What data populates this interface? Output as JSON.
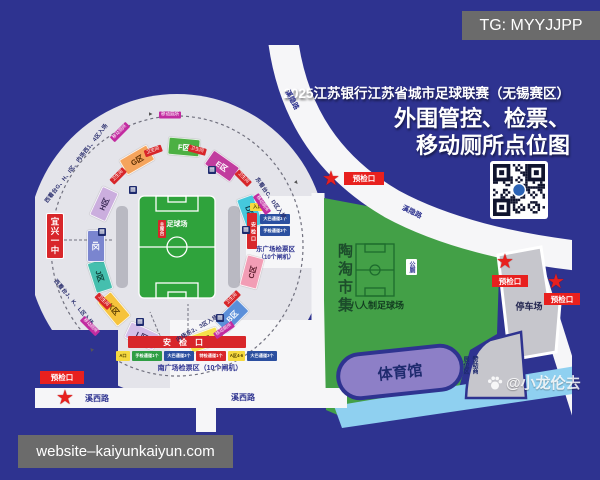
{
  "overlay": {
    "tg": "TG: MYYJJPP",
    "website": "website–kaiyunkaiyun.com"
  },
  "title": {
    "line1": "2025江苏银行江苏省城市足球联赛（无锡赛区）",
    "line2": "外围管控、检票、",
    "line3": "移动厕所点位图"
  },
  "stadium": {
    "pitch_label": "足球场",
    "rostrum": "主席台",
    "school": "宜兴一中",
    "sections": [
      {
        "id": "A",
        "label": "A区",
        "bg": "#f5e04a",
        "fg": "#4a3a00"
      },
      {
        "id": "B",
        "label": "B区",
        "bg": "#5b8fd9",
        "fg": "#ffffff"
      },
      {
        "id": "C",
        "label": "C区",
        "bg": "#f29db5",
        "fg": "#5a1c2c"
      },
      {
        "id": "D",
        "label": "D区",
        "bg": "#45c8dc",
        "fg": "#0e3a48"
      },
      {
        "id": "E",
        "label": "E区",
        "bg": "#c13c9e",
        "fg": "#ffffff"
      },
      {
        "id": "F",
        "label": "F区",
        "bg": "#4cb043",
        "fg": "#ffffff"
      },
      {
        "id": "G",
        "label": "G区",
        "bg": "#f5a45c",
        "fg": "#5a2c00"
      },
      {
        "id": "H",
        "label": "H区",
        "bg": "#cbaede",
        "fg": "#3a2a55"
      },
      {
        "id": "I",
        "label": "I区",
        "bg": "#7a85cf",
        "fg": "#ffffff"
      },
      {
        "id": "J",
        "label": "J区",
        "bg": "#45bfae",
        "fg": "#0e4038"
      },
      {
        "id": "K",
        "label": "K区",
        "bg": "#f6c33c",
        "fg": "#5a3c00"
      },
      {
        "id": "L",
        "label": "L区",
        "bg": "#d4bfe8",
        "fg": "#3a2a55"
      }
    ],
    "south_gate": {
      "bar": "安检口",
      "zone": "南广场检票区（10个闸机）",
      "channels": [
        {
          "label": "A口",
          "bg": "#f5d93f",
          "fg": "#4a3a00"
        },
        {
          "label": "手检通道1个",
          "bg": "#2f9e44",
          "fg": "#ffffff"
        },
        {
          "label": "大巴通道3个",
          "bg": "#2b4fa0",
          "fg": "#ffffff"
        },
        {
          "label": "特检通道1个",
          "bg": "#d8262a",
          "fg": "#ffffff"
        },
        {
          "label": "A区4-6",
          "bg": "#f5d93f",
          "fg": "#4a3a00"
        },
        {
          "label": "大巴通道3个",
          "bg": "#2b4fa0",
          "fg": "#ffffff"
        }
      ]
    },
    "east_gate": {
      "bar": "安检口",
      "entry": "入口",
      "zone_line1": "东广场检票区",
      "zone_line2": "（10个闸机）",
      "channels": [
        {
          "label": "大巴通道3个",
          "bg": "#2b4fa0",
          "fg": "#ffffff"
        },
        {
          "label": "手检通道3个",
          "bg": "#2b4fa0",
          "fg": "#ffffff"
        }
      ]
    },
    "notes": {
      "west_north": "西看台G、H、I区、内场西1、4区入场",
      "west_south": "西看台J、K、L区入场",
      "east_north": "东看台C、D区入场",
      "infield_south": "内场东2、3区入场"
    },
    "tags": {
      "toilet": "移动厕所",
      "restroom": "卫生间",
      "info_glyph": "▦"
    }
  },
  "map": {
    "market": "陶淘市集",
    "eight_field": "八人制足球场",
    "public_toilet": "公厕",
    "gym": "体育馆",
    "parking": "停车场",
    "sponsor_right": "赞助商",
    "sponsor_left": "展位区",
    "precheck": "预检口",
    "star": "★",
    "arrow_glyph": "▲",
    "roads": {
      "xixi_a": "溪西路",
      "xixi_b": "溪西路",
      "xiyin_a": "溪隐路",
      "xiyin_b": "溪隐路"
    }
  },
  "watermark": {
    "handle": "@小龙伦去"
  }
}
